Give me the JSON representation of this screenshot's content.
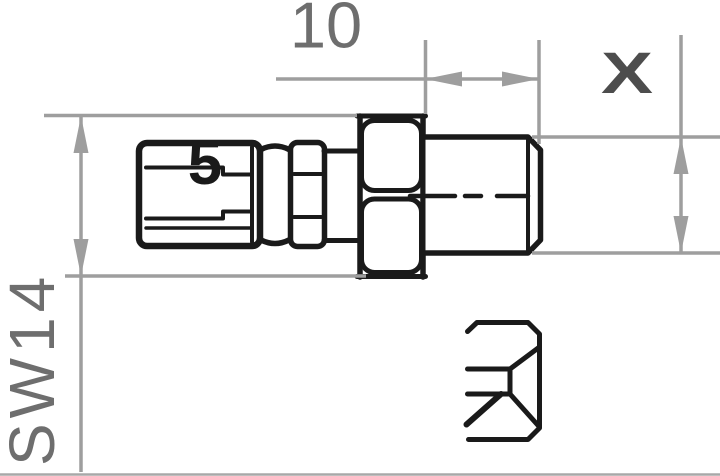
{
  "labels": {
    "length_dimension": "10",
    "diameter_dimension": "X",
    "wrench_size": "SW14",
    "part_marking": "5"
  },
  "colors": {
    "part_outline": "#1a1a1a",
    "dimension_lines": "#9e9e9e",
    "dimension_text": "#6e6e6e",
    "diameter_text": "#4d4d4d",
    "background": "#ffffff"
  }
}
